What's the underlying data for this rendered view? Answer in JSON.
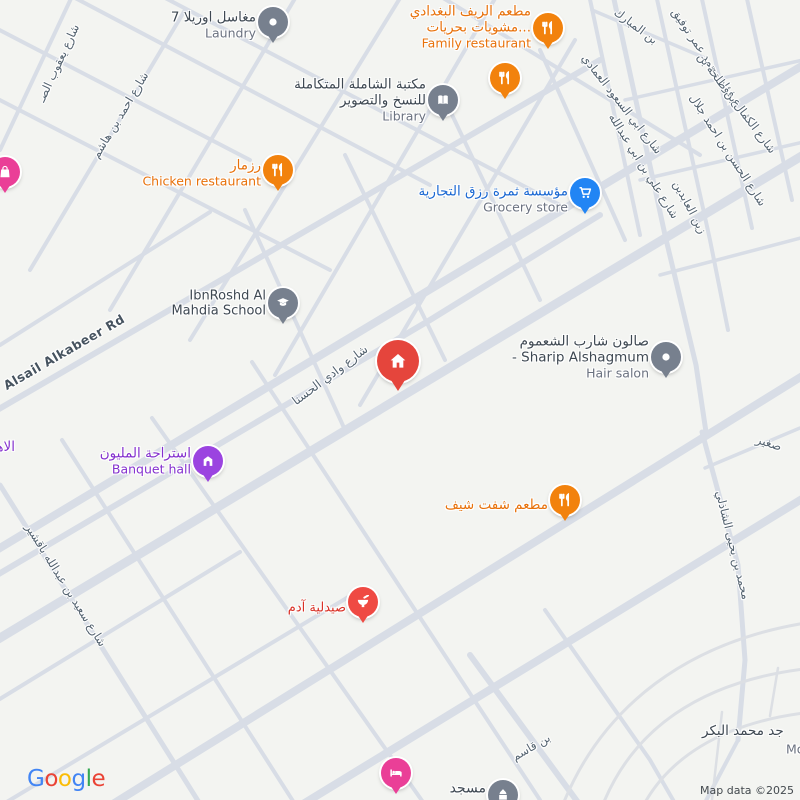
{
  "map": {
    "bg": "#f3f4f1",
    "road_color": "#d8dde6",
    "street_label_color": "#53626f"
  },
  "attribution": {
    "text": "Map data ©2025",
    "color": "#43494e"
  },
  "google_logo": {
    "letters": [
      {
        "ch": "G",
        "color": "#4285F4"
      },
      {
        "ch": "o",
        "color": "#EA4335"
      },
      {
        "ch": "o",
        "color": "#FBBC05"
      },
      {
        "ch": "g",
        "color": "#4285F4"
      },
      {
        "ch": "l",
        "color": "#34A853"
      },
      {
        "ch": "e",
        "color": "#EA4335"
      }
    ]
  },
  "pois": [
    {
      "id": "laundry",
      "x": 273,
      "y": 22,
      "pin": {
        "color": "#77808e",
        "icon": "dot"
      },
      "label": {
        "dy": 4,
        "lines": [
          {
            "t": "مغاسل اوريلا 7",
            "c": "#3e4852",
            "s": 13.5
          },
          {
            "t": "Laundry",
            "c": "#6b7280",
            "s": 12.5,
            "w": 400
          }
        ]
      }
    },
    {
      "id": "family-restaurant",
      "x": 548,
      "y": 28,
      "pin": {
        "color": "#f2820d",
        "icon": "restaurant"
      },
      "label": {
        "dy": 0,
        "lines": [
          {
            "t": "مطعم الريف البغدادي",
            "c": "#e8710a",
            "s": 13.5
          },
          {
            "t": "مشويات بحريات...",
            "c": "#e8710a",
            "s": 13.5
          },
          {
            "t": "Family restaurant",
            "c": "#e8710a",
            "s": 12.5,
            "w": 400
          }
        ]
      }
    },
    {
      "id": "restaurant-2",
      "x": 505,
      "y": 78,
      "pin": {
        "color": "#f2820d",
        "icon": "restaurant"
      }
    },
    {
      "id": "library",
      "x": 443,
      "y": 100,
      "pin": {
        "color": "#77808e",
        "icon": "book"
      },
      "label": {
        "dy": 1,
        "lines": [
          {
            "t": "مكتبة الشاملة المتكاملة",
            "c": "#3e4852",
            "s": 13.5
          },
          {
            "t": "للنسخ والتصوير",
            "c": "#3e4852",
            "s": 13.5
          },
          {
            "t": "Library",
            "c": "#6b7280",
            "s": 12.5,
            "w": 400
          }
        ]
      }
    },
    {
      "id": "chicken-restaurant",
      "x": 278,
      "y": 170,
      "pin": {
        "color": "#f2820d",
        "icon": "restaurant"
      },
      "label": {
        "dy": 4,
        "lines": [
          {
            "t": "رزمار",
            "c": "#e8710a",
            "s": 13.5
          },
          {
            "t": "Chicken restaurant",
            "c": "#e8710a",
            "s": 12.5,
            "w": 400
          }
        ]
      }
    },
    {
      "id": "pink-shop",
      "x": 5,
      "y": 172,
      "pin": {
        "color": "#ea3f97",
        "icon": "bag"
      }
    },
    {
      "id": "grocery",
      "x": 585,
      "y": 193,
      "pin": {
        "color": "#2285f4",
        "icon": "cart"
      },
      "label": {
        "dy": 7,
        "lines": [
          {
            "t": "مؤسسة ثمرة رزق التجارية",
            "c": "#1967d2",
            "s": 13.5
          },
          {
            "t": "Grocery store",
            "c": "#6b7280",
            "s": 12.5,
            "w": 400
          }
        ]
      }
    },
    {
      "id": "school",
      "x": 283,
      "y": 303,
      "pin": {
        "color": "#77808e",
        "icon": "school"
      },
      "label": {
        "dy": 1,
        "lines": [
          {
            "t": "IbnRoshd Al",
            "c": "#3e4852",
            "s": 13
          },
          {
            "t": "Mahdia School",
            "c": "#3e4852",
            "s": 13
          }
        ]
      }
    },
    {
      "id": "home-marker",
      "x": 398,
      "y": 361,
      "pin": {
        "color": "#e5453c",
        "icon": "house",
        "s": 42,
        "big": true
      }
    },
    {
      "id": "hair-salon",
      "x": 666,
      "y": 357,
      "pin": {
        "color": "#77808e",
        "icon": "dot"
      },
      "label": {
        "dy": 1,
        "lines": [
          {
            "t": "صالون شارب الشعموم",
            "c": "#3e4852",
            "s": 13.5
          },
          {
            "t": "- Sharip Alshagmum",
            "c": "#3e4852",
            "s": 13.5
          },
          {
            "t": "Hair salon",
            "c": "#6b7280",
            "s": 12.5,
            "w": 400
          }
        ]
      }
    },
    {
      "id": "banquet-hall",
      "x": 208,
      "y": 461,
      "pin": {
        "color": "#9b44e0",
        "icon": "banquet"
      },
      "label": {
        "dy": 1,
        "lines": [
          {
            "t": "استراحة المليون",
            "c": "#8430ce",
            "s": 13.5
          },
          {
            "t": "Banquet hall",
            "c": "#8430ce",
            "s": 12.5,
            "w": 400
          }
        ]
      }
    },
    {
      "id": "chef-restaurant",
      "x": 565,
      "y": 500,
      "pin": {
        "color": "#f2820d",
        "icon": "restaurant"
      },
      "label": {
        "dy": 6,
        "lines": [
          {
            "t": "مطعم شفت شيف",
            "c": "#e8710a",
            "s": 13.5
          }
        ]
      }
    },
    {
      "id": "adam-pharmacy",
      "x": 363,
      "y": 602,
      "pin": {
        "color": "#ef4a43",
        "icon": "pharmacy"
      },
      "label": {
        "dy": 6,
        "lines": [
          {
            "t": "صيدلية آدم",
            "c": "#d93025",
            "s": 13
          }
        ]
      }
    },
    {
      "id": "hotel",
      "x": 396,
      "y": 773,
      "pin": {
        "color": "#ea3f97",
        "icon": "bed"
      }
    },
    {
      "id": "mosque",
      "x": 503,
      "y": 795,
      "pin": {
        "color": "#77808e",
        "icon": "mosque"
      },
      "label": {
        "dy": -6,
        "lines": [
          {
            "t": "مسجد",
            "c": "#3e4852",
            "s": 14
          }
        ]
      }
    }
  ],
  "street_labels": [
    {
      "t": "شارع يعقوب الصـ",
      "x": 58,
      "y": 63,
      "r": -65
    },
    {
      "t": "شارع احمد بن هاشم",
      "x": 120,
      "y": 115,
      "r": -59
    },
    {
      "t": "بن المبارك",
      "x": 636,
      "y": 26,
      "r": 37
    },
    {
      "t": "شارع فؤاد محمد عمر توفيق",
      "x": 712,
      "y": 65,
      "r": 56
    },
    {
      "t": "شارع الكمال بن طلحة بن",
      "x": 737,
      "y": 103,
      "r": 53
    },
    {
      "t": "شارع الحسن بن احمد جلال",
      "x": 728,
      "y": 150,
      "r": 57
    },
    {
      "t": "زين العابدين",
      "x": 690,
      "y": 207,
      "r": 62
    },
    {
      "t": "شارع ابي السعود العمادي",
      "x": 622,
      "y": 104,
      "r": 52
    },
    {
      "t": "شارع علي بن ابي عبدالله",
      "x": 644,
      "y": 166,
      "r": 58
    },
    {
      "t": "شارع وادي الحسنا",
      "x": 330,
      "y": 375,
      "r": -37,
      "s": 12
    },
    {
      "t": "Alsail Alkabeer Rd",
      "x": 64,
      "y": 352,
      "r": -30,
      "s": 12.5,
      "c": "#46535f",
      "w": 700,
      "ls": 0.5
    },
    {
      "t": "شارع سعيد بن عبدالله باقشير",
      "x": 66,
      "y": 585,
      "r": 58
    },
    {
      "t": "محمد بن يحيى الشاذلي",
      "x": 733,
      "y": 545,
      "r": 76
    },
    {
      "t": "صغير",
      "x": 769,
      "y": 443,
      "r": 18,
      "s": 12
    },
    {
      "t": "بن قاسم",
      "x": 531,
      "y": 747,
      "r": -30
    }
  ],
  "free_labels": [
    {
      "t": "الاهلـ",
      "x": -12,
      "y": 447,
      "c": "#8430ce",
      "s": 13.5,
      "w": 500
    },
    {
      "t": "جد محمد البكر",
      "x": 702,
      "y": 731,
      "c": "#3e4852",
      "s": 13.5,
      "w": 500
    },
    {
      "t": "Mo",
      "x": 786,
      "y": 749,
      "c": "#6b7280",
      "s": 12.5,
      "w": 400
    }
  ],
  "roads": [
    {
      "d": "M -20 560 L 820 55",
      "w": 8
    },
    {
      "d": "M -20 650 L 820 145",
      "w": 9
    },
    {
      "d": "M 100 812 L 820 365",
      "w": 8
    },
    {
      "d": "M -20 585 L 430 320 L 600 215",
      "w": 6
    },
    {
      "d": "M -20 420 L 600 60",
      "w": 6
    },
    {
      "d": "M 290 812 L 820 488",
      "w": 8
    },
    {
      "d": "M 0 150 L 75 -10",
      "w": 4
    },
    {
      "d": "M 30 270 L 185 10",
      "w": 4
    },
    {
      "d": "M 110 310 L 300 -10",
      "w": 4
    },
    {
      "d": "M 190 340 L 405 -10",
      "w": 4
    },
    {
      "d": "M 275 375 L 500 -10",
      "w": 4
    },
    {
      "d": "M 360 405 L 575 40",
      "w": 4
    },
    {
      "d": "M -10 25 L 250 160",
      "w": 4
    },
    {
      "d": "M -10 95 L 330 270",
      "w": 4
    },
    {
      "d": "M 60 -10 L 430 185",
      "w": 4
    },
    {
      "d": "M 150 -10 L 560 205",
      "w": 4
    },
    {
      "d": "M 430 -10 L 700 155",
      "w": 4
    },
    {
      "d": "M 0 345 L 210 212",
      "w": 4
    },
    {
      "d": "M 245 210 L 345 430",
      "w": 4
    },
    {
      "d": "M 345 155 L 445 360",
      "w": 4
    },
    {
      "d": "M 445 100 L 540 300",
      "w": 4
    },
    {
      "d": "M 540 50 L 625 240",
      "w": 4
    },
    {
      "d": "M 588 -10 L 640 235",
      "w": 4
    },
    {
      "d": "M 612 -10 L 665 235 L 696 365 L 706 432",
      "w": 5
    },
    {
      "d": "M 655 -10 L 710 240 L 728 330",
      "w": 4
    },
    {
      "d": "M 700 -10 L 752 228",
      "w": 4
    },
    {
      "d": "M 745 -10 L 792 200",
      "w": 4
    },
    {
      "d": "M 592 10 L 705 58",
      "w": 3.5
    },
    {
      "d": "M 625 100 L 812 58",
      "w": 3.5
    },
    {
      "d": "M 640 180 L 812 140",
      "w": 3.5
    },
    {
      "d": "M 660 275 L 812 235",
      "w": 3.5
    },
    {
      "d": "M 702 432 L 738 565 L 745 660 L 738 740",
      "w": 5
    },
    {
      "d": "M 705 468 L 800 428",
      "w": 3.5
    },
    {
      "d": "M 0 485 L 205 812",
      "w": 5
    },
    {
      "d": "M 62 440 L 300 812",
      "w": 4
    },
    {
      "d": "M 152 418 L 430 812",
      "w": 4
    },
    {
      "d": "M 252 362 L 540 800",
      "w": 4
    },
    {
      "d": "M -10 705 L 240 552",
      "w": 4
    },
    {
      "d": "M -10 812 L 360 590",
      "w": 4
    },
    {
      "d": "M 470 655 L 585 812",
      "w": 6
    },
    {
      "d": "M 545 610 L 650 760 L 680 812",
      "w": 4
    },
    {
      "d": "M 738 740 L 700 812",
      "w": 4
    },
    {
      "d": "M 600 812 C 630 730 700 680 812 668",
      "w": 3,
      "c": "#dcdfe4"
    },
    {
      "d": "M 640 812 C 665 760 720 722 812 712",
      "w": 3,
      "c": "#dcdfe4"
    },
    {
      "d": "M 560 812 C 600 705 690 640 812 622",
      "w": 3,
      "c": "#dcdfe4"
    },
    {
      "d": "M 712 800 L 722 712",
      "w": 2.5,
      "c": "#dcdfe4"
    },
    {
      "d": "M 770 716 L 778 668",
      "w": 2.5,
      "c": "#dcdfe4"
    }
  ]
}
